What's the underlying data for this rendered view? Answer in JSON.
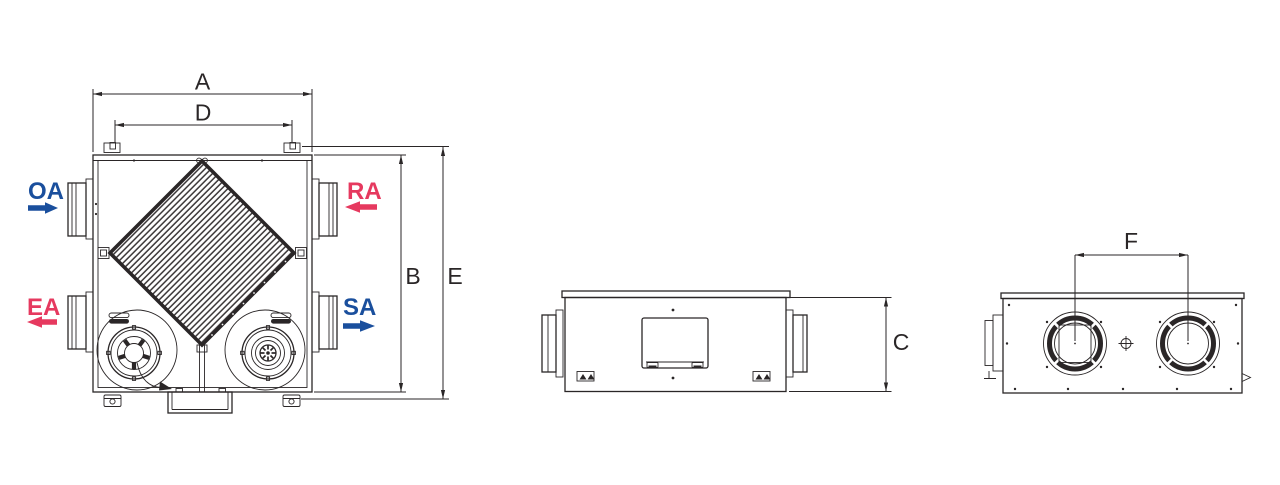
{
  "drawing": {
    "dimension_labels": {
      "a": "A",
      "d": "D",
      "b": "B",
      "e": "E",
      "c": "C",
      "f": "F"
    },
    "flow_labels": {
      "oa": {
        "label": "OA",
        "color": "#1a4f9d",
        "direction": "right"
      },
      "ra": {
        "label": "RA",
        "color": "#e6395f",
        "direction": "left"
      },
      "ea": {
        "label": "EA",
        "color": "#e6395f",
        "direction": "left"
      },
      "sa": {
        "label": "SA",
        "color": "#1a4f9d",
        "direction": "right"
      }
    },
    "colors": {
      "line": "#2a2627",
      "outdoor_supply_blue": "#1a4f9d",
      "return_exhaust_pink": "#e6395f",
      "background": "#ffffff"
    }
  }
}
